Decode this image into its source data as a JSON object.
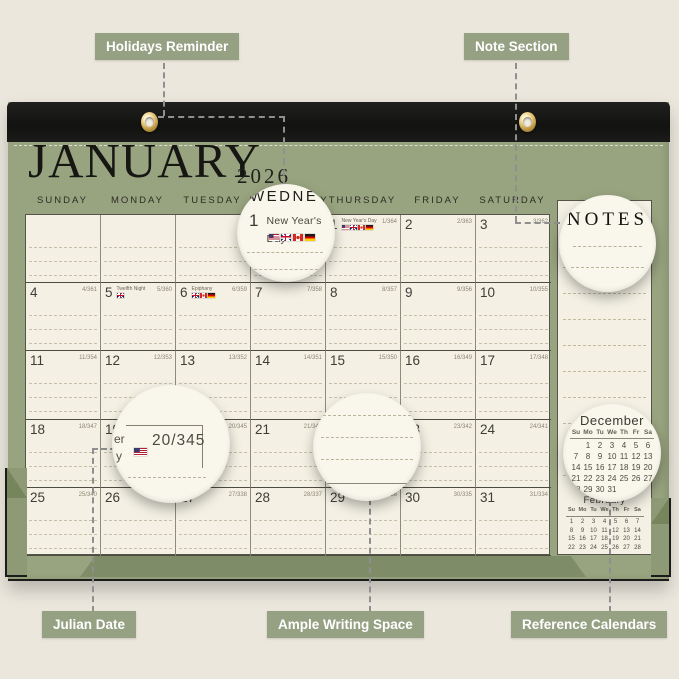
{
  "callouts": {
    "holidays_reminder": "Holidays Reminder",
    "note_section": "Note Section",
    "julian_date": "Julian Date",
    "ample_writing_space": "Ample Writing Space",
    "reference_calendars": "Reference Calendars"
  },
  "calendar": {
    "month": "JANUARY",
    "year": "2026",
    "day_headers": [
      "SUNDAY",
      "MONDAY",
      "TUESDAY",
      "WEDNESDAY",
      "THURSDAY",
      "FRIDAY",
      "SATURDAY"
    ],
    "notes_title": "NOTES",
    "weeks": [
      [
        {
          "d": "",
          "j": ""
        },
        {
          "d": "",
          "j": ""
        },
        {
          "d": "",
          "j": ""
        },
        {
          "d": "",
          "j": ""
        },
        {
          "d": "1",
          "j": "1/364",
          "h": "New Year's Day",
          "flags": [
            "us",
            "uk",
            "ca",
            "de"
          ]
        },
        {
          "d": "2",
          "j": "2/363"
        },
        {
          "d": "3",
          "j": "3/362"
        }
      ],
      [
        {
          "d": "4",
          "j": "4/361"
        },
        {
          "d": "5",
          "j": "5/360",
          "h": "Twelfth Night",
          "flags": [
            "uk"
          ]
        },
        {
          "d": "6",
          "j": "6/359",
          "h": "Epiphany",
          "flags": [
            "uk",
            "ca",
            "de"
          ]
        },
        {
          "d": "7",
          "j": "7/358"
        },
        {
          "d": "8",
          "j": "8/357"
        },
        {
          "d": "9",
          "j": "9/356"
        },
        {
          "d": "10",
          "j": "10/355"
        }
      ],
      [
        {
          "d": "11",
          "j": "11/354"
        },
        {
          "d": "12",
          "j": "12/353"
        },
        {
          "d": "13",
          "j": "13/352"
        },
        {
          "d": "14",
          "j": "14/351"
        },
        {
          "d": "15",
          "j": "15/350"
        },
        {
          "d": "16",
          "j": "16/349"
        },
        {
          "d": "17",
          "j": "17/348"
        }
      ],
      [
        {
          "d": "18",
          "j": "18/347"
        },
        {
          "d": "19",
          "j": "19/346",
          "h": "Martin Luther King Jr. Day",
          "flags": [
            "us"
          ]
        },
        {
          "d": "20",
          "j": "20/345"
        },
        {
          "d": "21",
          "j": "21/344"
        },
        {
          "d": "22",
          "j": "22/343"
        },
        {
          "d": "23",
          "j": "23/342"
        },
        {
          "d": "24",
          "j": "24/341"
        }
      ],
      [
        {
          "d": "25",
          "j": "25/340"
        },
        {
          "d": "26",
          "j": "26/339"
        },
        {
          "d": "27",
          "j": "27/338"
        },
        {
          "d": "28",
          "j": "28/337"
        },
        {
          "d": "29",
          "j": "29/336"
        },
        {
          "d": "30",
          "j": "30/335"
        },
        {
          "d": "31",
          "j": "31/334"
        }
      ]
    ],
    "mini_calendars": [
      {
        "title": "December",
        "weekday_header": [
          "Su",
          "Mo",
          "Tu",
          "We",
          "Th",
          "Fr",
          "Sa"
        ],
        "weeks": [
          [
            "",
            "1",
            "2",
            "3",
            "4",
            "5",
            "6"
          ],
          [
            "7",
            "8",
            "9",
            "10",
            "11",
            "12",
            "13"
          ],
          [
            "14",
            "15",
            "16",
            "17",
            "18",
            "19",
            "20"
          ],
          [
            "21",
            "22",
            "23",
            "24",
            "25",
            "26",
            "27"
          ],
          [
            "28",
            "29",
            "30",
            "31",
            "",
            "",
            ""
          ]
        ]
      },
      {
        "title": "February",
        "weekday_header": [
          "Su",
          "Mo",
          "Tu",
          "We",
          "Th",
          "Fr",
          "Sa"
        ],
        "weeks": [
          [
            "1",
            "2",
            "3",
            "4",
            "5",
            "6",
            "7"
          ],
          [
            "8",
            "9",
            "10",
            "11",
            "12",
            "13",
            "14"
          ],
          [
            "15",
            "16",
            "17",
            "18",
            "19",
            "20",
            "21"
          ],
          [
            "22",
            "23",
            "24",
            "25",
            "26",
            "27",
            "28"
          ]
        ]
      }
    ]
  },
  "magnifiers": {
    "holiday": {
      "weekday_fragment": "WEDNE",
      "day": "1",
      "holiday": "New Year's Day",
      "flags": [
        "us",
        "uk",
        "ca",
        "de"
      ]
    },
    "notes": {
      "title": "NOTES"
    },
    "julian": {
      "text_fragments": [
        "er",
        "y"
      ],
      "flags": [
        "us"
      ],
      "julian_value": "20/345"
    }
  },
  "colors": {
    "pad_green": "#98a37f",
    "leather_black": "#161614",
    "paper_cream": "#f4f1e4",
    "callout_green": "#96a183",
    "page_background": "#ebe7dd",
    "grommet_gold": "#c09a46"
  }
}
